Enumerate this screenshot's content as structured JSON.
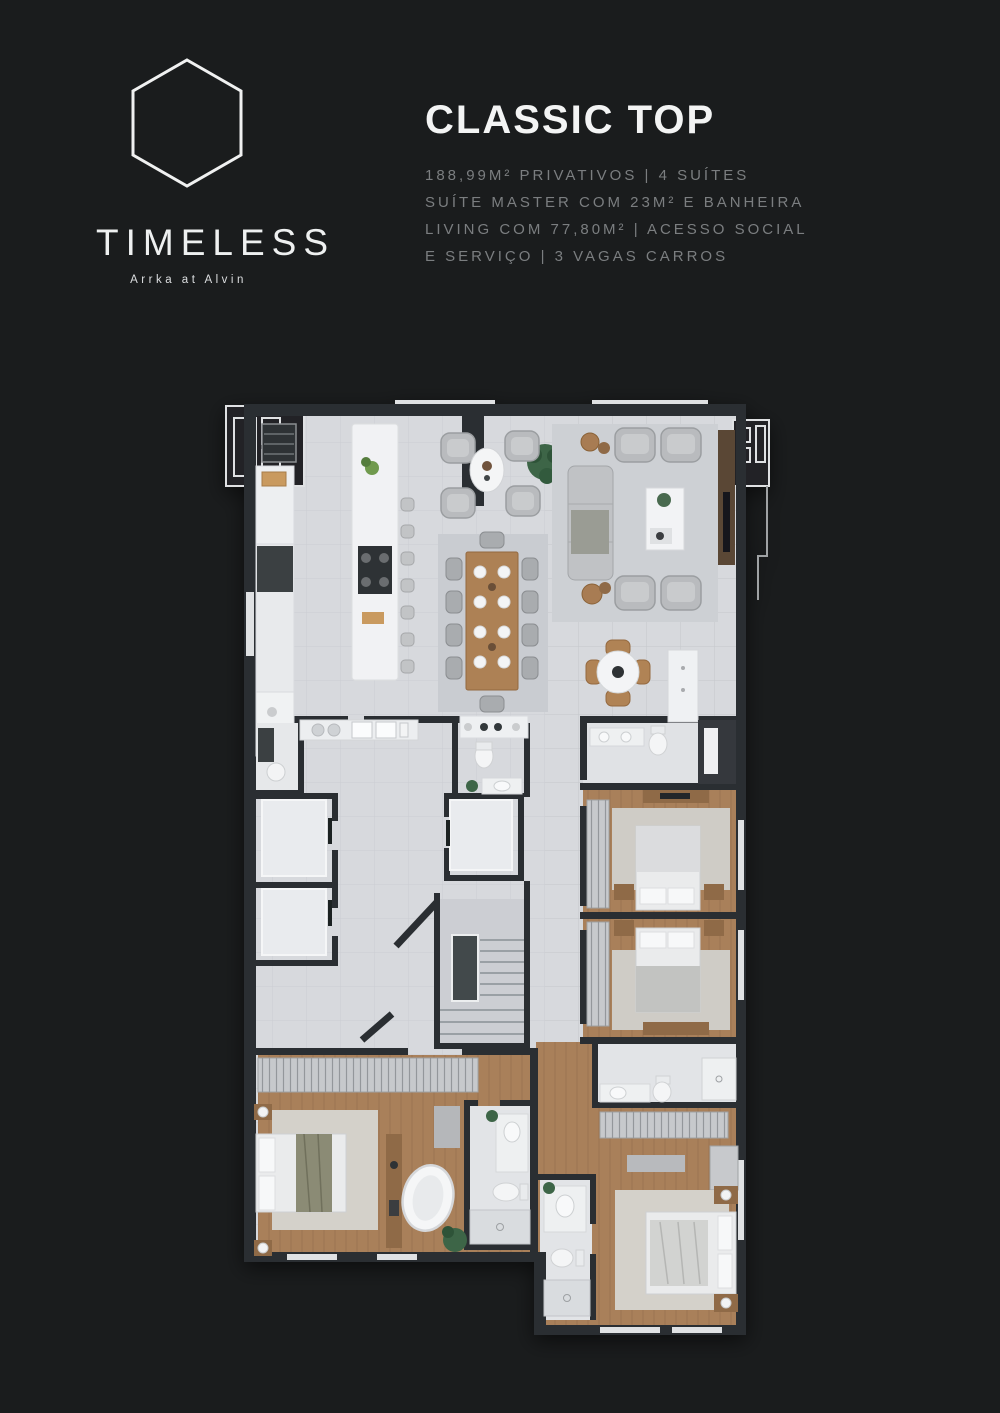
{
  "page": {
    "background_color": "#1a1c1d",
    "accent_color": "#f3f4f4"
  },
  "brand": {
    "name": "TIMELESS",
    "tagline": "Arrka at Alvin",
    "logo_icon": "hexagon-outline-icon"
  },
  "plan_header": {
    "title": "CLASSIC TOP",
    "specs": [
      "188,99M² PRIVATIVOS | 4 SUÍTES",
      "SUÍTE MASTER COM 23M² E BANHEIRA",
      "LIVING COM 77,80M² | ACESSO SOCIAL",
      "E SERVIÇO | 3 VAGAS CARROS"
    ]
  },
  "floor_plan": {
    "description": "Top-down 3D render of apartment floor plan",
    "floor_color": "#d7d9dd",
    "wall_color": "#2b2f32",
    "wood_color": "#a9805a"
  }
}
